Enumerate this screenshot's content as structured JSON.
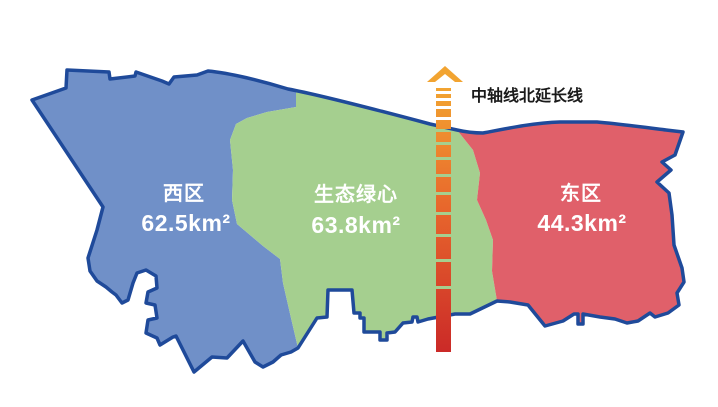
{
  "map": {
    "background": "#ffffff",
    "border_color": "#1f4a9a",
    "regions": [
      {
        "id": "west",
        "name": "西区",
        "area": "62.5km²",
        "color": "#7090c8"
      },
      {
        "id": "green-heart",
        "name": "生态绿心",
        "area": "63.8km²",
        "color": "#a5cf8f"
      },
      {
        "id": "east",
        "name": "东区",
        "area": "44.3km²",
        "color": "#e0606a"
      }
    ],
    "axis": {
      "label": "中轴线北延长线",
      "color_top": "#f2a431",
      "color_mid": "#e8672c",
      "color_bottom": "#cb2a28"
    }
  }
}
